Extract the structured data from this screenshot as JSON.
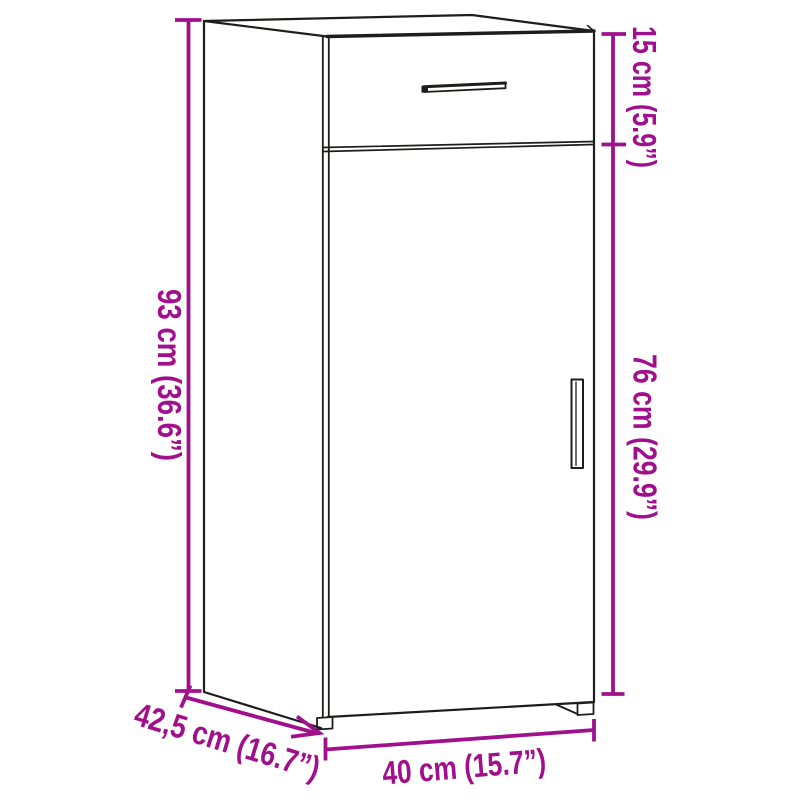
{
  "diagram": {
    "kind": "furniture-dimension-line-drawing",
    "colors": {
      "accent": "#a0108c",
      "ink": "#1d1d1b",
      "background": "#ffffff"
    },
    "dimensions": {
      "height": {
        "label": "93 cm (36.6”)",
        "cm": 93,
        "inches": 36.6,
        "position": "left",
        "measures": "total height"
      },
      "drawer_height": {
        "label": "15 cm (5.9”)",
        "cm": 15,
        "inches": 5.9,
        "position": "top-right",
        "measures": "drawer section height"
      },
      "door_height": {
        "label": "76 cm (29.9”)",
        "cm": 76,
        "inches": 29.9,
        "position": "right",
        "measures": "door section height"
      },
      "depth": {
        "label": "42,5 cm (16.7”)",
        "cm": 42.5,
        "inches": 16.7,
        "position": "bottom-left-diagonal",
        "measures": "depth"
      },
      "width": {
        "label": "40 cm (15.7”)",
        "cm": 40,
        "inches": 15.7,
        "position": "bottom",
        "measures": "width"
      }
    },
    "furniture": {
      "parts": [
        "top-face",
        "left-side-panel",
        "drawer-front",
        "drawer-handle",
        "door",
        "door-handle",
        "front-left-foot",
        "front-right-foot"
      ]
    }
  }
}
